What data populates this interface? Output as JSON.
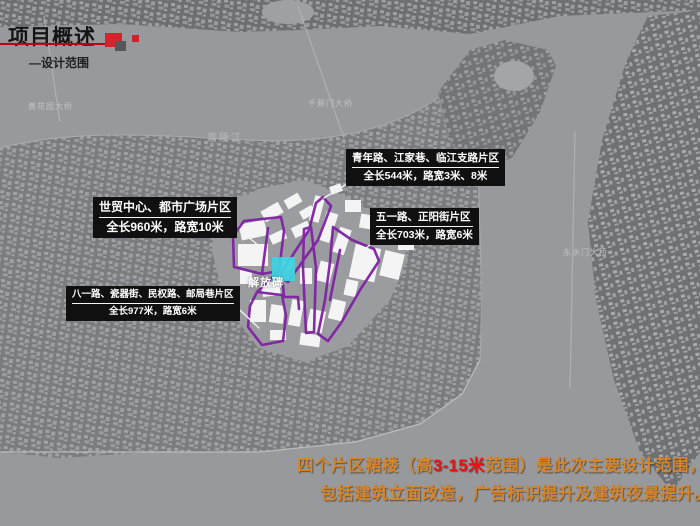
{
  "slide": {
    "title": "项目概述",
    "subtitle": "—设计范围"
  },
  "map": {
    "river_label": "嘉陵江",
    "bridge_labels": [
      "黄花园大桥",
      "千厮门大桥",
      "东水门大桥"
    ],
    "landmark_label": "解放碑",
    "districts": [
      {
        "name": "世贸中心、都市广场片区",
        "detail": "全长960米，路宽10米"
      },
      {
        "name": "青年路、江家巷、临江支路片区",
        "detail": "全长544米，路宽3米、8米"
      },
      {
        "name": "五一路、正阳街片区",
        "detail": "全长703米，路宽6米"
      },
      {
        "name": "八一路、瓷器街、民权路、邮局巷片区",
        "detail": "全长977米，路宽6米"
      }
    ],
    "colors": {
      "district_outline": "#7e22a3",
      "landmark_marker": "#3ed2de"
    }
  },
  "footer": {
    "line1_pre": "四个片区裙楼（高",
    "line1_highlight": "3-15米",
    "line1_post": "范围）是此次主要设计范围，",
    "line2": "包括建筑立面改造，广告标识提升及建筑夜景提升。",
    "colors": {
      "text": "#d6862a",
      "highlight": "#ee1111"
    }
  }
}
